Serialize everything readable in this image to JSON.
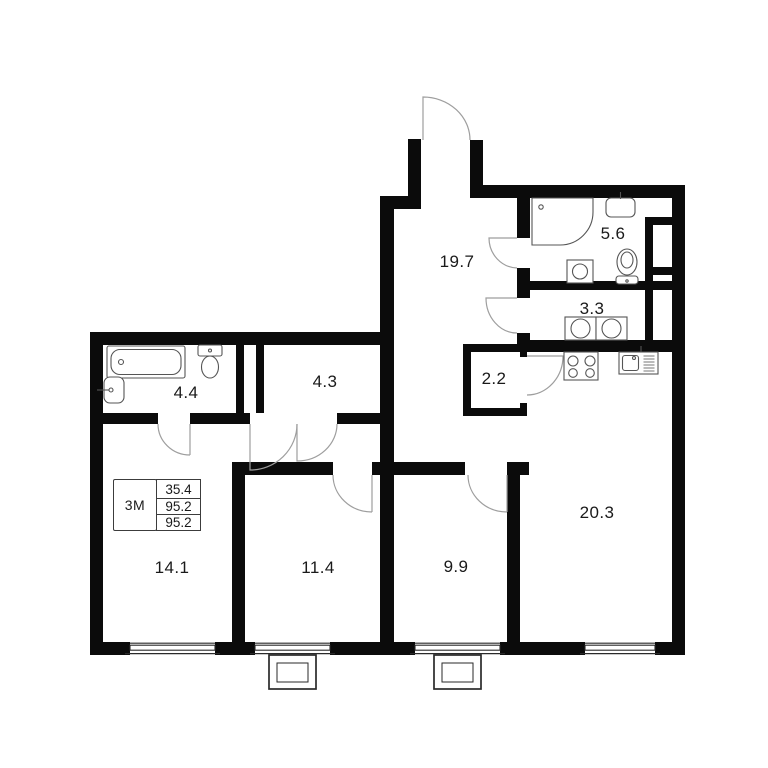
{
  "unit_info": {
    "type_label": "3M",
    "rows": [
      "35.4",
      "95.2",
      "95.2"
    ]
  },
  "rooms": {
    "hallway": "19.7",
    "bathroom": "5.6",
    "laundry": "3.3",
    "storage": "2.2",
    "bathroom_2": "4.4",
    "wardrobe": "4.3",
    "bedroom_1": "14.1",
    "bedroom_2": "11.4",
    "bedroom_3": "9.9",
    "kitchen_living": "20.3"
  },
  "colors": {
    "wall": "#0b0b0b",
    "door_arc": "#9e9e9e",
    "fixture_stroke": "#555555",
    "label_text": "#1a1a1a"
  }
}
